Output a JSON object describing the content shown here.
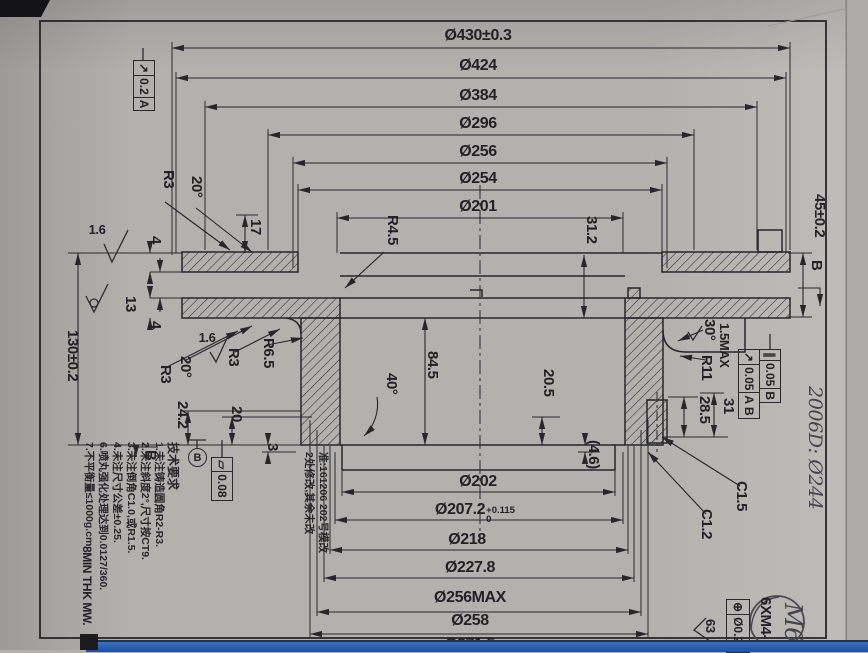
{
  "dims": {
    "top": [
      "Ø430±0.3",
      "Ø424",
      "Ø384",
      "Ø296",
      "Ø256",
      "Ø254",
      "Ø201"
    ],
    "bottom": [
      "Ø202",
      "Ø207.2",
      "Ø218",
      "Ø227.8",
      "Ø256MAX",
      "Ø258",
      "Ø271.5"
    ],
    "bore_tol_sup": "+0.115",
    "bore_tol_sub": "0",
    "left": {
      "overall": "130±0.2",
      "slot": "13",
      "plate_top": "4",
      "plate_bottom": "4",
      "rim": "17",
      "hub_depth": "24.2",
      "hub_inner": "20",
      "step": "3"
    },
    "right": {
      "offset": "45±0.2",
      "flange_h": "31.2",
      "bore_h": "84.5",
      "seat": "20.5",
      "ring_a": "28.5",
      "ring_b": "31",
      "gap": "(4.6)",
      "clearance": "1.5MAX"
    }
  },
  "features": {
    "r3_top": "R3",
    "angle_top": "20°",
    "r45": "R4.5",
    "angle_mid": "40°",
    "r3_a": "R3",
    "angle_low": "20°",
    "r3_b": "R3",
    "r65": "R6.5",
    "angle_right": "30°",
    "r11": "R11",
    "c15": "C1.5",
    "c12": "C1.2",
    "rough_a": "1.6",
    "rough_b": "1.6",
    "rough_c": "63",
    "thread": "6XM4-"
  },
  "gdt": {
    "runout_top": {
      "sym": "↗",
      "val": "0.2",
      "datum": "A"
    },
    "parallel": {
      "sym": "∥",
      "val": "0.05",
      "datum": "B"
    },
    "runout_right": {
      "sym": "↗",
      "val": "0.05",
      "datum": "A B"
    },
    "flatness": {
      "sym": "▱",
      "val": "0.08"
    },
    "position": {
      "sym": "⊕",
      "val": "Ø0.25"
    },
    "datum_b": "B",
    "section_b": "B"
  },
  "notes": {
    "title": "技术要求",
    "items": [
      "1.未注铸造圆角R2-R3.",
      "2.未注斜度2°,尺寸按CT9.",
      "3.未注倒角C1.0,或R1.5.",
      "4.未注尺寸公差±0.25.",
      "6.喷丸强化处理达到0.0127/360.",
      "7.不平衡量≤1000g.cm."
    ],
    "footer": "8MIN THK  MW.",
    "revision_a": "准:161206 202号模改",
    "revision_b": "2处修改,其余未改"
  },
  "handwritten": {
    "margin": "2006D: Ø244",
    "stamp": "M6"
  }
}
